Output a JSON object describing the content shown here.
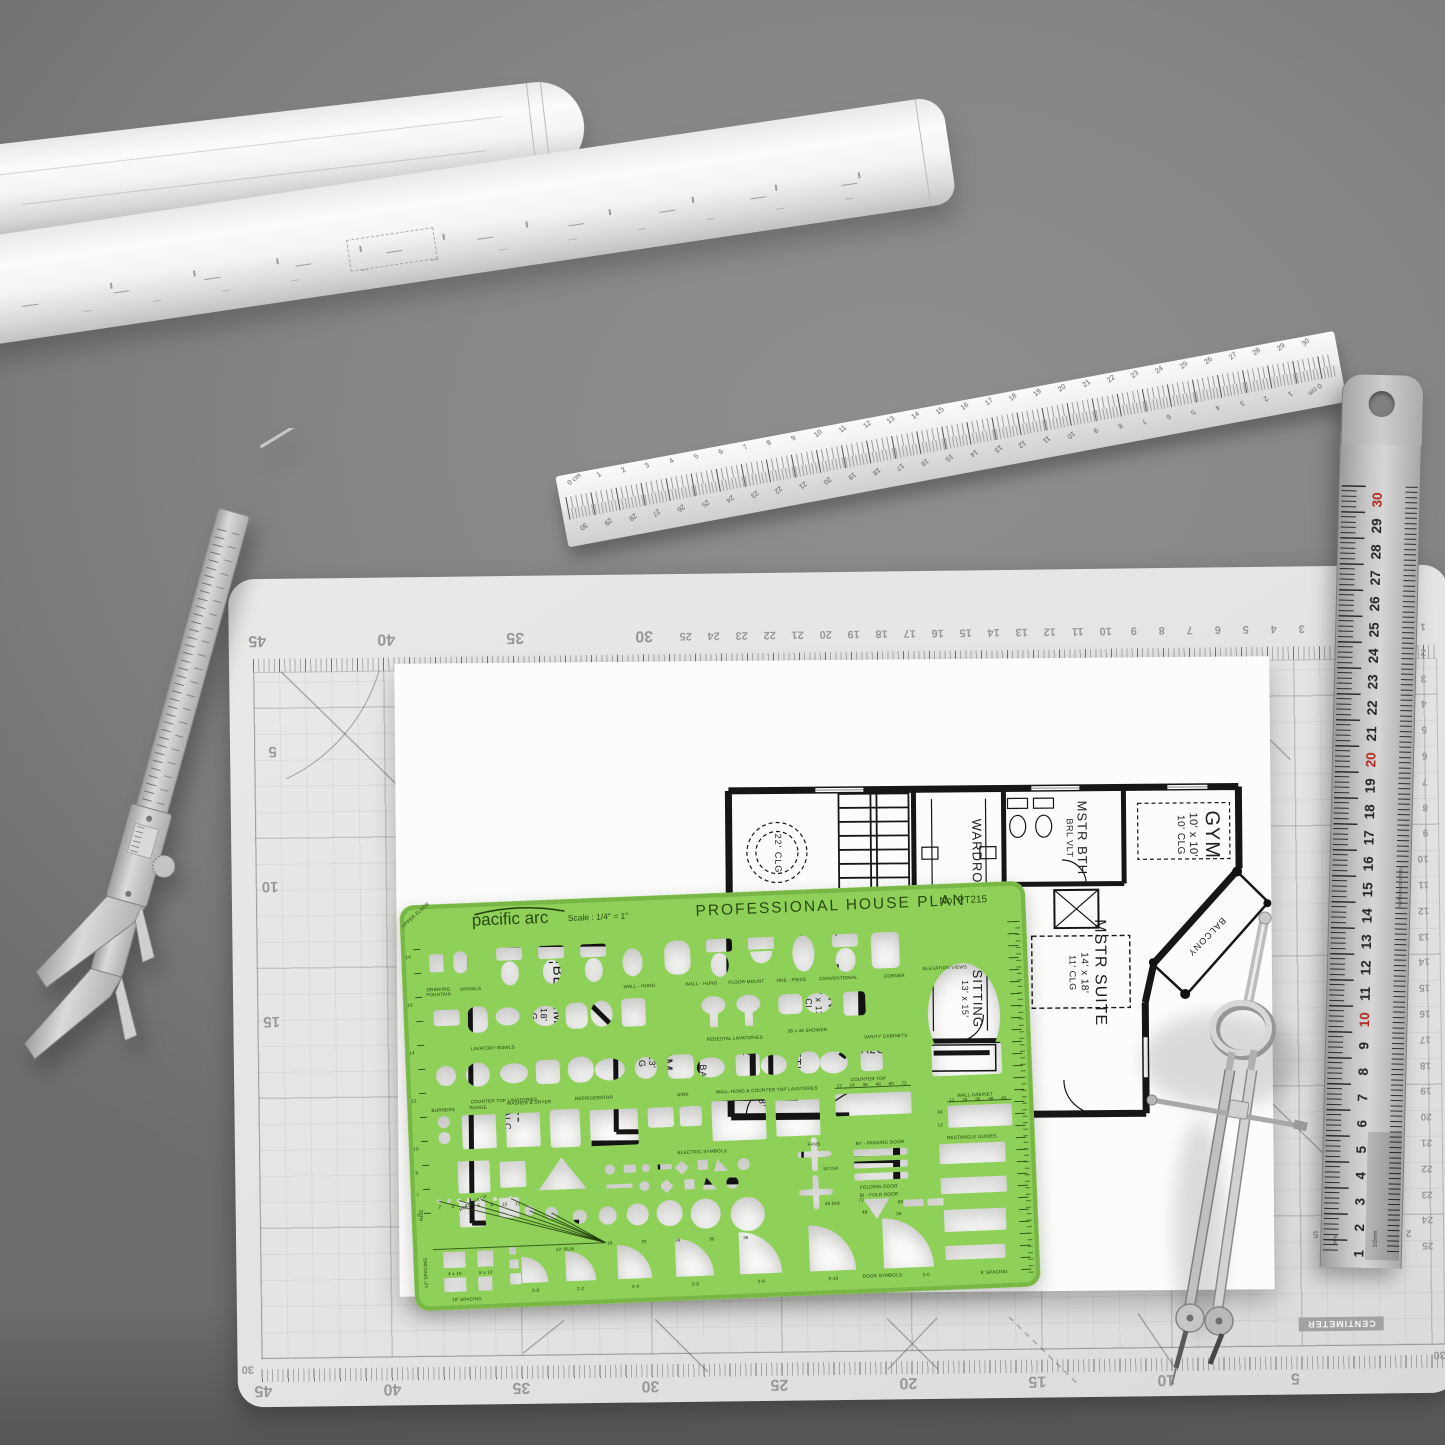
{
  "template": {
    "brand": "pacific arc",
    "scale_note": "Scale : 1/4\" = 1\"",
    "title": "PROFESSIONAL HOUSE PLAN",
    "model": "No. PT215",
    "corner": "UPPER FLOOR",
    "labels": {
      "drinking_fountain": "DRINKING FOUNTAIN",
      "urinals": "URINALS",
      "wall_hung_a": "WALL - HUNG",
      "wall_hung_b": "WALL - HUNG",
      "floor_mount": "FLOOR MOUNT",
      "one_piece": "ONE - PIECE",
      "conventional": "CONVENTIONAL",
      "corner_wc": "CORNER",
      "elevation_views": "ELEVATION VIEWS",
      "lavatory_bowls": "LAVATORY BOWLS",
      "pedestal_lavatories": "PEDESTAL LAVATORIES",
      "counter_top_lavatories": "COUNTER TOP LAVATORIES",
      "wall_hung_counter_top_lavatories": "WALL-HUNG & COUNTER TOP LAVATORIES",
      "burners": "BURNERS",
      "range": "RANGE",
      "washer_dryer": "WASHER & DRYER",
      "refrigerator": "REFRIGERATOR",
      "sink": "SINK",
      "counter_top": "COUNTER TOP",
      "wall_cabinet": "WALL CABINET",
      "vanity_cabinets": "VANITY CABINETS",
      "shower_3648": "36 x 48 SHOWER",
      "electric_symbols": "ELECTRIC SYMBOLS",
      "fans": "FANS",
      "dia52": "52 DIA",
      "dia48": "48 DIA",
      "by_passing_door": "BY - PASSING DOOR",
      "folding_door": "FOLDING DOOR",
      "bi_fold_door": "BI - FOLD DOOR",
      "rectangle_guides": "RECTANGLE GUIDES",
      "roof_pitch": "ROOF PITCH",
      "rise": "RISE",
      "run12": "12' RUN",
      "door_symbols": "DOOR SYMBOLS",
      "spacing12": "12\" SPACING",
      "spacing10": "10' SPACING",
      "spacing8": "8' SPACING",
      "size_4x16": "4 x 16",
      "size_8x12": "8 x 12"
    },
    "left_numbers": [
      "14",
      "16",
      "14",
      "12",
      "10",
      "8",
      "7",
      "6"
    ],
    "rise_numbers": [
      "2",
      "3",
      "4",
      "6",
      "8",
      "10",
      "12"
    ],
    "circle_numbers": [
      "18",
      "20",
      "24",
      "30",
      "36"
    ],
    "counter_ticks": [
      "12",
      "24",
      "36",
      "48",
      "60",
      "72"
    ],
    "cabinet_ticks": [
      "12",
      "24",
      "36",
      "48",
      "60"
    ],
    "cabinet_side": [
      "34",
      "12"
    ],
    "bifold_sizes": [
      "72",
      "60",
      "48",
      "36"
    ],
    "door_sizes": [
      "2-0",
      "2-2",
      "2-4",
      "2-6",
      "2-8",
      "2-10",
      "3-0"
    ]
  },
  "floor_plan": {
    "rooms": {
      "gym": {
        "name": "GYM",
        "dims": "10' x 10'",
        "clg": "10' CLG"
      },
      "mstr_bth": {
        "name": "MSTR BTH",
        "note": "BRL VLT"
      },
      "wardrobe": {
        "name": "WARDROBE"
      },
      "mstr_suite": {
        "name": "MSTR SUITE",
        "dims": "14' x 18'",
        "clg": "11' CLG"
      },
      "balcony_upper": {
        "name": "BALCONY"
      },
      "sitting": {
        "name": "SITTING",
        "dims": "13' x 15'"
      },
      "loggia": {
        "name": "LOGGIA"
      },
      "ceiling22": {
        "name": "22' CLG"
      },
      "bedrm3": {
        "name": "BEDRM 3",
        "dims": "13' x 18'",
        "clg": "11' CLG"
      },
      "bedrm4": {
        "name": "BEDRM 4",
        "dims": "12' x 13'",
        "clg": "11' CLG"
      },
      "bedrm2": {
        "name": "BEDRM 2",
        "dims": "13' x 13'",
        "clg": "10' CLG"
      },
      "sitting2": {
        "name": "SITTING"
      },
      "balcony_lower": {
        "name": "BALCONY"
      },
      "balc": {
        "name": "BALC"
      },
      "bar": {
        "name": "BAR"
      },
      "b2": {
        "name": "B 2"
      },
      "b3": {
        "name": "B 3"
      },
      "bath_5x8": {
        "name": "5' x 8'"
      }
    }
  },
  "mat": {
    "unit_label": "CENTIMETER",
    "angle_label": "45°",
    "corner_label": "30",
    "top_left_numbers": [
      "45",
      "40",
      "35",
      "30"
    ],
    "top_cm_numbers": [
      "25",
      "24",
      "23",
      "22",
      "21",
      "20",
      "19",
      "18",
      "17",
      "16",
      "15",
      "14",
      "13",
      "12",
      "11",
      "10",
      "9",
      "8",
      "7",
      "6",
      "5",
      "4",
      "3"
    ],
    "bottom_numbers": [
      "45",
      "40",
      "35",
      "30",
      "25",
      "20",
      "15",
      "10",
      "5"
    ],
    "left_numbers": [
      "5",
      "10",
      "15"
    ],
    "right_numbers": [
      "1",
      "2",
      "3",
      "4",
      "5",
      "6",
      "7",
      "8",
      "9",
      "10",
      "11",
      "12",
      "13",
      "14",
      "15",
      "16",
      "17",
      "18",
      "19",
      "20",
      "21",
      "22",
      "23",
      "24",
      "25"
    ],
    "corner_scale_numbers": [
      "5",
      "4",
      "3",
      "2"
    ]
  },
  "steel_ruler": {
    "numbers": [
      "30",
      "29",
      "28",
      "27",
      "26",
      "25",
      "24",
      "23",
      "22",
      "21",
      "20",
      "19",
      "18",
      "17",
      "16",
      "15",
      "14",
      "13",
      "12",
      "11",
      "10",
      "9",
      "8",
      "7",
      "6",
      "5",
      "4",
      "3",
      "2",
      "1"
    ],
    "brand_note": "HARDENED STEEL",
    "unit_mm": "mm",
    "unit_half_mm": "1/2mm"
  },
  "scale_ruler": {
    "numbers": [
      "0 cm",
      "1",
      "2",
      "3",
      "4",
      "5",
      "6",
      "7",
      "8",
      "9",
      "10",
      "11",
      "12",
      "13",
      "14",
      "15",
      "16",
      "17",
      "18",
      "19",
      "20",
      "21",
      "22",
      "23",
      "24",
      "25",
      "26",
      "27",
      "28",
      "29",
      "30"
    ]
  }
}
